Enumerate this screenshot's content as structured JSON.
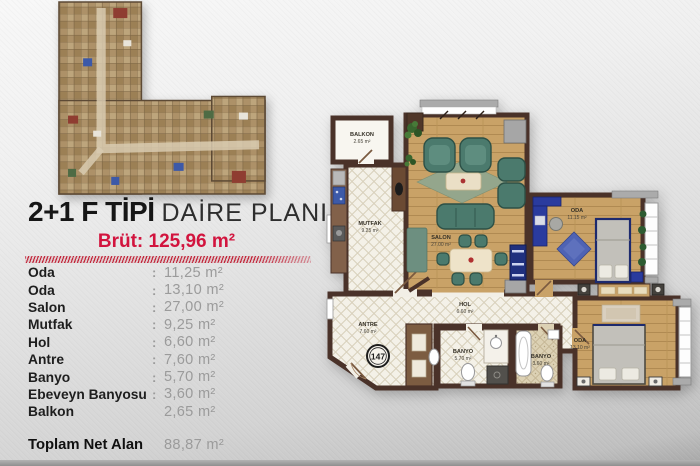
{
  "header": {
    "title_bold": "2+1 F TİPİ",
    "title_regular": "DAİRE PLANI",
    "brut": "Brüt: 125,96 m²"
  },
  "area_table": {
    "rows": [
      {
        "label": "Oda",
        "colon": ":",
        "value": "11,25 m²"
      },
      {
        "label": "Oda",
        "colon": ":",
        "value": "13,10 m²"
      },
      {
        "label": "Salon",
        "colon": ":",
        "value": "27,00 m²"
      },
      {
        "label": "Mutfak",
        "colon": ":",
        "value": "9,25 m²"
      },
      {
        "label": "Hol",
        "colon": ":",
        "value": "6,60 m²"
      },
      {
        "label": "Antre",
        "colon": ":",
        "value": "7,60 m²"
      },
      {
        "label": "Banyo",
        "colon": ":",
        "value": "5,70 m²"
      },
      {
        "label": "Ebeveyn Banyosu",
        "colon": ":",
        "value": "3,60 m²"
      },
      {
        "label": "Balkon",
        "colon": "",
        "value": "2,65 m²"
      }
    ],
    "total": {
      "label": "Toplam Net Alan",
      "value": "88,87 m²"
    }
  },
  "floor_plan": {
    "unit_number": "147",
    "rooms": {
      "balkon": {
        "name": "BALKON",
        "area": "2.65 m²"
      },
      "mutfak": {
        "name": "MUTFAK",
        "area": "9.25 m²"
      },
      "salon": {
        "name": "SALON",
        "area": "27.00 m²"
      },
      "oda_1": {
        "name": "ODA",
        "area": "11.15 m²"
      },
      "oda_2": {
        "name": "ODA",
        "area": "13.10 m²"
      },
      "hol": {
        "name": "HOL",
        "area": "6.60 m²"
      },
      "antre": {
        "name": "ANTRE",
        "area": "7.60 m²"
      },
      "banyo": {
        "name": "BANYO",
        "area": "5.70 m²"
      },
      "ebeveyn_banyo": {
        "name": "BANYO",
        "area": "3.60 m²"
      }
    }
  },
  "colors": {
    "accent_red": "#d2143e",
    "wall_brown": "#4a3229",
    "wood_floor": "#c9a267",
    "sofa_teal": "#4b7a6d",
    "furniture_navy": "#2a3b9e"
  }
}
